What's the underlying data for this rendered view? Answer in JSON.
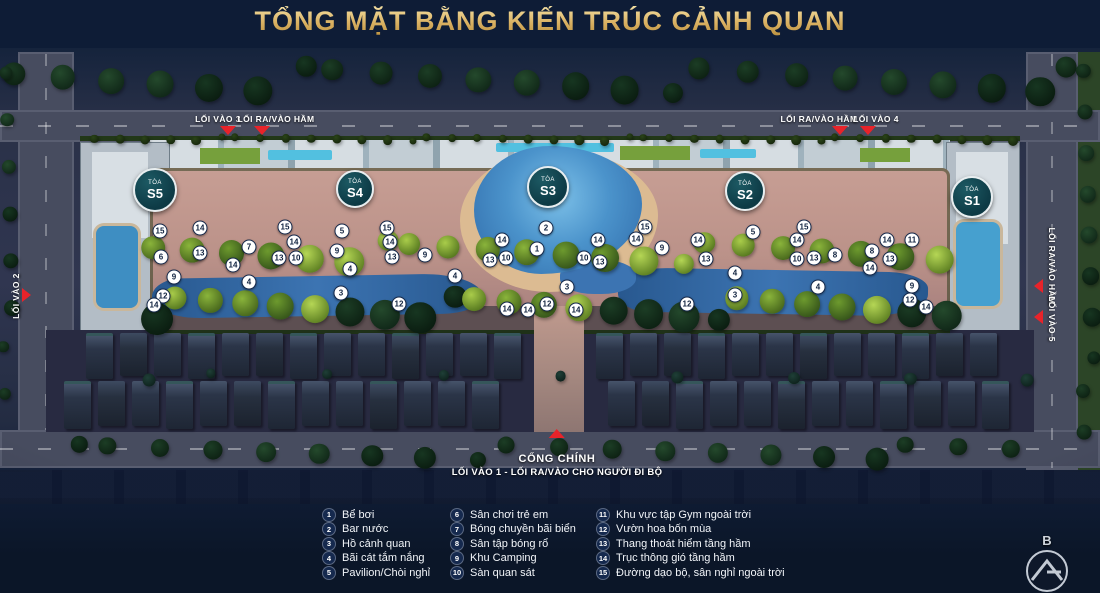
{
  "title": "TỔNG MẶT BẰNG KIẾN TRÚC CẢNH QUAN",
  "entrances": {
    "top_left": [
      {
        "label": "LỐI VÀO 3"
      },
      {
        "label": "LỐI RA/VÀO HẦM"
      }
    ],
    "top_right": [
      {
        "label": "LỐI RA/VÀO HẦM"
      },
      {
        "label": "LỐI VÀO 4"
      }
    ],
    "left": {
      "label": "LỐI VÀO 2"
    },
    "right": [
      {
        "label": "LỐI RA/VÀO HẦM"
      },
      {
        "label": "LỐI VÀO 5"
      }
    ],
    "gate": {
      "title": "CỔNG CHÍNH",
      "subtitle": "LỐI VÀO 1 - LỐI RA/VÀO CHO NGƯỜI ĐI BỘ"
    }
  },
  "towers": {
    "prefix": "TÒA",
    "items": [
      {
        "name": "S5",
        "x": 155,
        "y": 190,
        "d": 40
      },
      {
        "name": "S4",
        "x": 355,
        "y": 189,
        "d": 34
      },
      {
        "name": "S3",
        "x": 548,
        "y": 187,
        "d": 38
      },
      {
        "name": "S2",
        "x": 745,
        "y": 191,
        "d": 36
      },
      {
        "name": "S1",
        "x": 972,
        "y": 197,
        "d": 38
      }
    ]
  },
  "markers": [
    {
      "n": 15,
      "x": 160,
      "y": 231
    },
    {
      "n": 14,
      "x": 200,
      "y": 228
    },
    {
      "n": 13,
      "x": 200,
      "y": 253
    },
    {
      "n": 6,
      "x": 161,
      "y": 257
    },
    {
      "n": 9,
      "x": 174,
      "y": 277
    },
    {
      "n": 12,
      "x": 163,
      "y": 296
    },
    {
      "n": 14,
      "x": 154,
      "y": 305
    },
    {
      "n": 7,
      "x": 249,
      "y": 247
    },
    {
      "n": 14,
      "x": 233,
      "y": 265
    },
    {
      "n": 4,
      "x": 249,
      "y": 282
    },
    {
      "n": 15,
      "x": 285,
      "y": 227
    },
    {
      "n": 14,
      "x": 294,
      "y": 242
    },
    {
      "n": 13,
      "x": 279,
      "y": 258
    },
    {
      "n": 10,
      "x": 296,
      "y": 258
    },
    {
      "n": 5,
      "x": 342,
      "y": 231
    },
    {
      "n": 9,
      "x": 337,
      "y": 251
    },
    {
      "n": 4,
      "x": 350,
      "y": 269
    },
    {
      "n": 3,
      "x": 341,
      "y": 293
    },
    {
      "n": 15,
      "x": 387,
      "y": 228
    },
    {
      "n": 14,
      "x": 390,
      "y": 242
    },
    {
      "n": 13,
      "x": 392,
      "y": 257
    },
    {
      "n": 12,
      "x": 399,
      "y": 304
    },
    {
      "n": 9,
      "x": 425,
      "y": 255
    },
    {
      "n": 2,
      "x": 546,
      "y": 228
    },
    {
      "n": 1,
      "x": 537,
      "y": 249
    },
    {
      "n": 14,
      "x": 502,
      "y": 240
    },
    {
      "n": 13,
      "x": 490,
      "y": 260
    },
    {
      "n": 10,
      "x": 506,
      "y": 258
    },
    {
      "n": 4,
      "x": 455,
      "y": 276
    },
    {
      "n": 3,
      "x": 567,
      "y": 287
    },
    {
      "n": 14,
      "x": 598,
      "y": 240
    },
    {
      "n": 10,
      "x": 584,
      "y": 258
    },
    {
      "n": 13,
      "x": 600,
      "y": 262
    },
    {
      "n": 15,
      "x": 645,
      "y": 227
    },
    {
      "n": 14,
      "x": 636,
      "y": 239
    },
    {
      "n": 9,
      "x": 662,
      "y": 248
    },
    {
      "n": 14,
      "x": 698,
      "y": 240
    },
    {
      "n": 13,
      "x": 706,
      "y": 259
    },
    {
      "n": 12,
      "x": 547,
      "y": 304
    },
    {
      "n": 14,
      "x": 507,
      "y": 309
    },
    {
      "n": 14,
      "x": 528,
      "y": 310
    },
    {
      "n": 14,
      "x": 576,
      "y": 310
    },
    {
      "n": 12,
      "x": 687,
      "y": 304
    },
    {
      "n": 5,
      "x": 753,
      "y": 232
    },
    {
      "n": 15,
      "x": 804,
      "y": 227
    },
    {
      "n": 14,
      "x": 797,
      "y": 240
    },
    {
      "n": 10,
      "x": 797,
      "y": 259
    },
    {
      "n": 13,
      "x": 814,
      "y": 258
    },
    {
      "n": 8,
      "x": 835,
      "y": 255
    },
    {
      "n": 4,
      "x": 818,
      "y": 287
    },
    {
      "n": 4,
      "x": 735,
      "y": 273
    },
    {
      "n": 3,
      "x": 735,
      "y": 295
    },
    {
      "n": 8,
      "x": 872,
      "y": 251
    },
    {
      "n": 14,
      "x": 870,
      "y": 268
    },
    {
      "n": 13,
      "x": 890,
      "y": 259
    },
    {
      "n": 14,
      "x": 887,
      "y": 240
    },
    {
      "n": 11,
      "x": 912,
      "y": 240
    },
    {
      "n": 9,
      "x": 912,
      "y": 286
    },
    {
      "n": 12,
      "x": 910,
      "y": 300
    },
    {
      "n": 14,
      "x": 926,
      "y": 307
    }
  ],
  "legend": {
    "columns": [
      {
        "items": [
          {
            "n": "1",
            "label": "Bể bơi"
          },
          {
            "n": "2",
            "label": "Bar nước"
          },
          {
            "n": "3",
            "label": "Hồ cảnh quan"
          },
          {
            "n": "4",
            "label": "Bãi cát tắm nắng"
          },
          {
            "n": "5",
            "label": "Pavilion/Chòi nghỉ"
          }
        ]
      },
      {
        "items": [
          {
            "n": "6",
            "label": "Sân chơi trẻ em"
          },
          {
            "n": "7",
            "label": "Bóng chuyền bãi biển"
          },
          {
            "n": "8",
            "label": "Sân tập bóng rổ"
          },
          {
            "n": "9",
            "label": "Khu Camping"
          },
          {
            "n": "10",
            "label": "Sàn quan sát"
          }
        ]
      },
      {
        "items": [
          {
            "n": "11",
            "label": "Khu vực tập Gym ngoài trời"
          },
          {
            "n": "12",
            "label": "Vườn hoa bốn mùa"
          },
          {
            "n": "13",
            "label": "Thang thoát hiểm tầng hầm"
          },
          {
            "n": "14",
            "label": "Trục thông gió tầng hầm"
          },
          {
            "n": "15",
            "label": "Đường dạo bộ, sân nghỉ ngoài trời"
          }
        ]
      }
    ]
  },
  "compass": {
    "label": "B"
  },
  "colors": {
    "accent_gold": "#d9b969",
    "marker_red": "#e8232a",
    "tower_teal": "#134049",
    "water_blue": "#3c74b2",
    "legend_navy": "#15294e"
  }
}
